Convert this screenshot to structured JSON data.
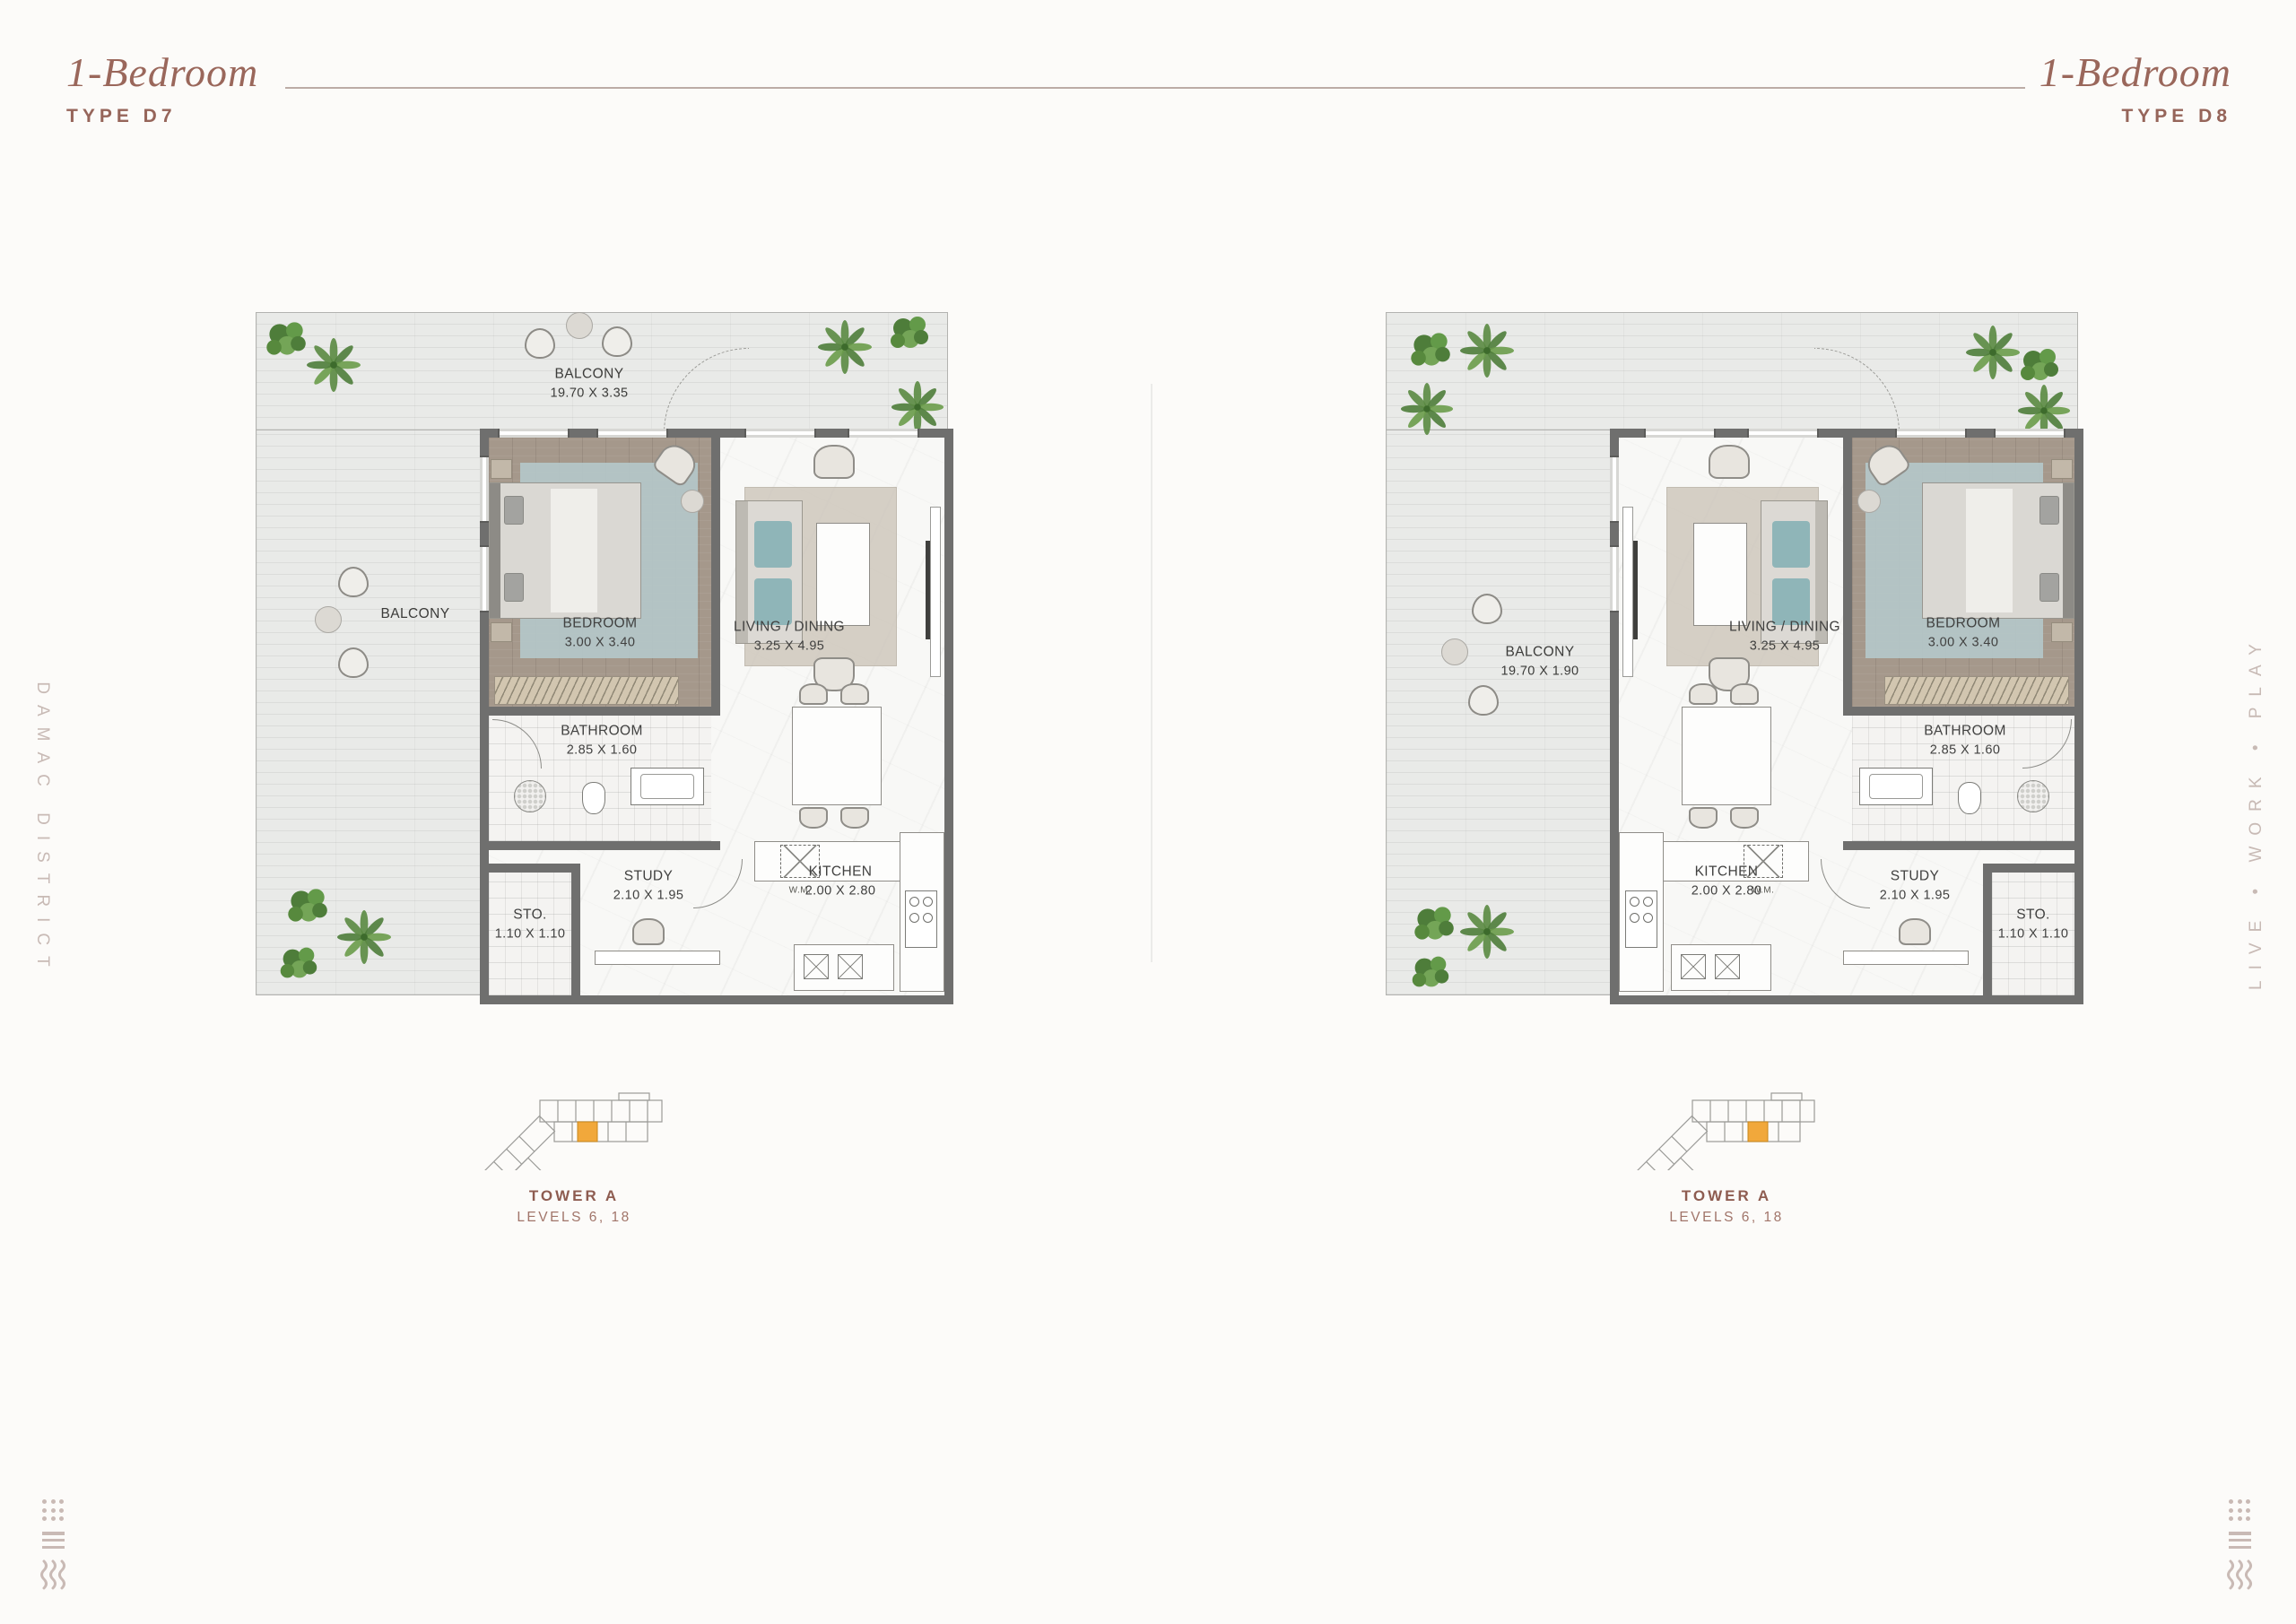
{
  "headers": {
    "left": {
      "title": "1-Bedroom",
      "type": "TYPE D7"
    },
    "right": {
      "title": "1-Bedroom",
      "type": "TYPE D8"
    }
  },
  "side_labels": {
    "left": "DAMAC DISTRICT",
    "right": "LIVE • WORK • PLAY"
  },
  "plans": [
    {
      "id": "D7",
      "balcony_top": {
        "name": "BALCONY",
        "dims": "19.70 X 3.35"
      },
      "balcony_side": {
        "name": "BALCONY"
      },
      "rooms": {
        "bedroom": {
          "name": "BEDROOM",
          "dims": "3.00 X 3.40"
        },
        "living": {
          "name": "LIVING / DINING",
          "dims": "3.25 X 4.95"
        },
        "bathroom": {
          "name": "BATHROOM",
          "dims": "2.85 X 1.60"
        },
        "storage": {
          "name": "STO.",
          "dims": "1.10 X 1.10"
        },
        "study": {
          "name": "STUDY",
          "dims": "2.10 X 1.95"
        },
        "kitchen": {
          "name": "KITCHEN",
          "dims": "2.00 X 2.80"
        },
        "washing_machine": "W.M."
      },
      "key_plan": {
        "tower": "TOWER A",
        "levels": "LEVELS 6, 18"
      }
    },
    {
      "id": "D8",
      "balcony_side": {
        "name": "BALCONY",
        "dims": "19.70 X 1.90"
      },
      "rooms": {
        "bedroom": {
          "name": "BEDROOM",
          "dims": "3.00 X 3.40"
        },
        "living": {
          "name": "LIVING / DINING",
          "dims": "3.25 X 4.95"
        },
        "bathroom": {
          "name": "BATHROOM",
          "dims": "2.85 X 1.60"
        },
        "storage": {
          "name": "STO.",
          "dims": "1.10 X 1.10"
        },
        "study": {
          "name": "STUDY",
          "dims": "2.10 X 1.95"
        },
        "kitchen": {
          "name": "KITCHEN",
          "dims": "2.00 X 2.80"
        },
        "washing_machine": "W.M."
      },
      "key_plan": {
        "tower": "TOWER A",
        "levels": "LEVELS 6, 18"
      }
    }
  ],
  "colors": {
    "heading": "#9a675b",
    "side_text": "#c8bab5",
    "rule": "#bcaca6",
    "wall": "#6f6f6e",
    "terrace": "#e9eae8",
    "bedroom_floor": "#a5988b",
    "rug_teal": "#b5c8ca",
    "key_highlight": "#f1a83b",
    "tower_label": "#8e5c50",
    "logo_mark": "#c9bab5"
  }
}
